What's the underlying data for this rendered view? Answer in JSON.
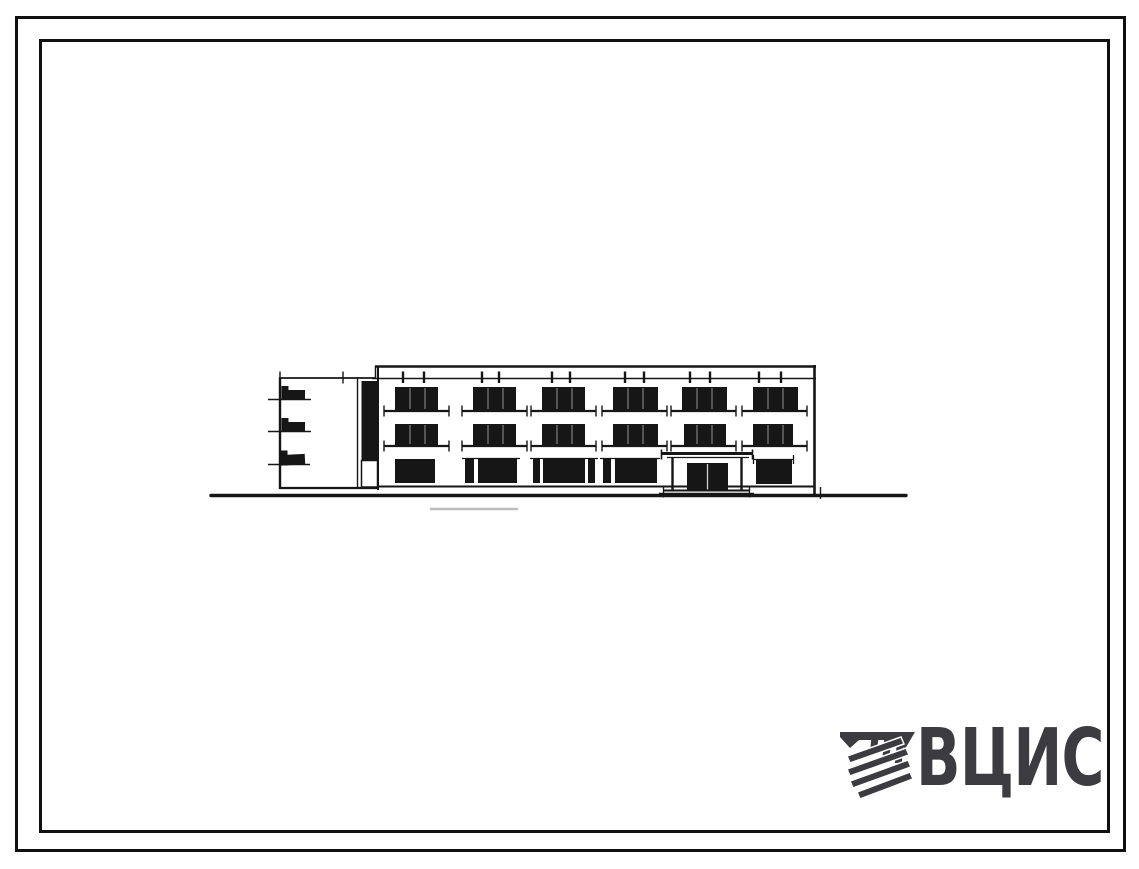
{
  "canvas": {
    "width": 1139,
    "height": 869,
    "background": "#ffffff"
  },
  "frames": {
    "style": "double rectangular border",
    "border_color": "#101010"
  },
  "colors": {
    "drawing_ink": "#161616",
    "logo_gray": "#3b3b40",
    "pencil_smudge": "#bdbdbd",
    "paper": "#ffffff"
  },
  "elevation": {
    "subject": "three-storey building front elevation, hand-drawn scan",
    "storeys": 3,
    "window_columns": 6,
    "features": [
      "left end wing with three balcony end marks",
      "dark vertical stairwell glazing strip",
      "parapet band with paired roof ticks",
      "window sill lines with end ticks",
      "central entrance porch with canopy, two posts, double door and steps",
      "ground line"
    ]
  },
  "logo": {
    "text": "ВЦИС",
    "icon": "diagonal-striped-emblem-icon",
    "color": "#3b3b40"
  }
}
